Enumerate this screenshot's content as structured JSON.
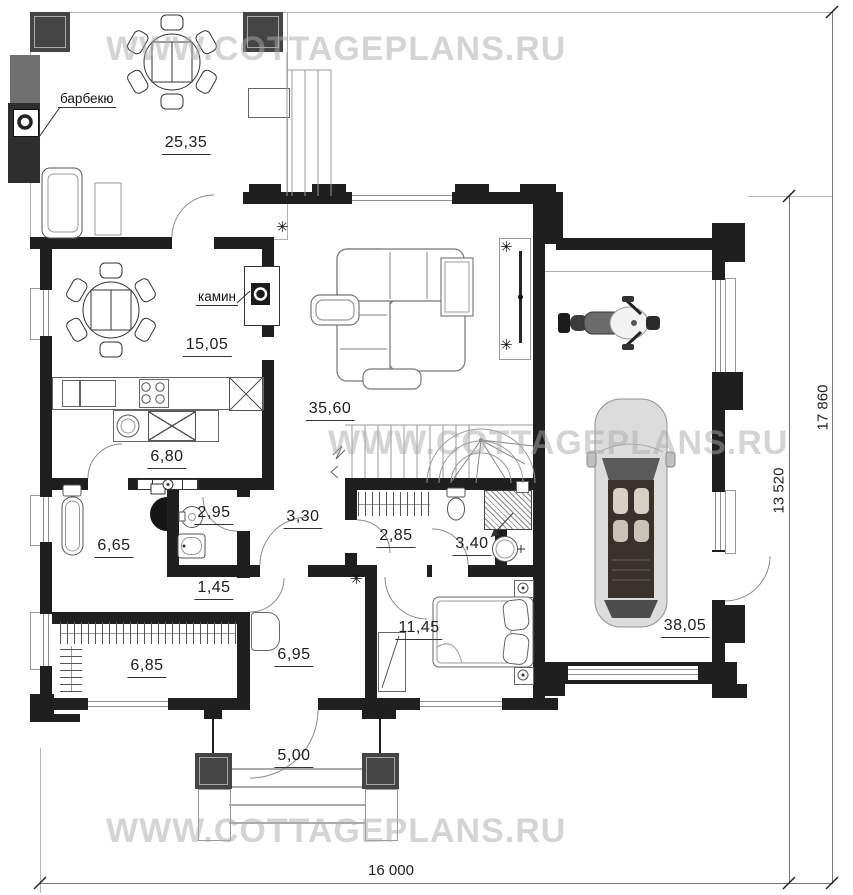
{
  "watermark": {
    "text": "WWW.COTTAGEPLANS.RU",
    "color": "#ababab"
  },
  "annotations": {
    "barbecue": "барбекю",
    "fireplace": "камин"
  },
  "areas": {
    "terrace": "25,35",
    "dining": "15,05",
    "living": "35,60",
    "kitchen": "6,80",
    "sauna": "6,65",
    "bath_small": "2,95",
    "hall": "3,30",
    "closet": "2,85",
    "shower_room": "3,40",
    "storage": "1,45",
    "wardrobe": "6,85",
    "entry": "6,95",
    "bedroom": "11,45",
    "garage": "38,05",
    "porch": "5,00"
  },
  "dimensions": {
    "overall_width": "16 000",
    "overall_height": "17 860",
    "inner_height": "13 520"
  },
  "icons": {
    "plant": "✳"
  },
  "colors": {
    "wall": "#1f1f1f",
    "watermark_gray": "#ababab"
  }
}
